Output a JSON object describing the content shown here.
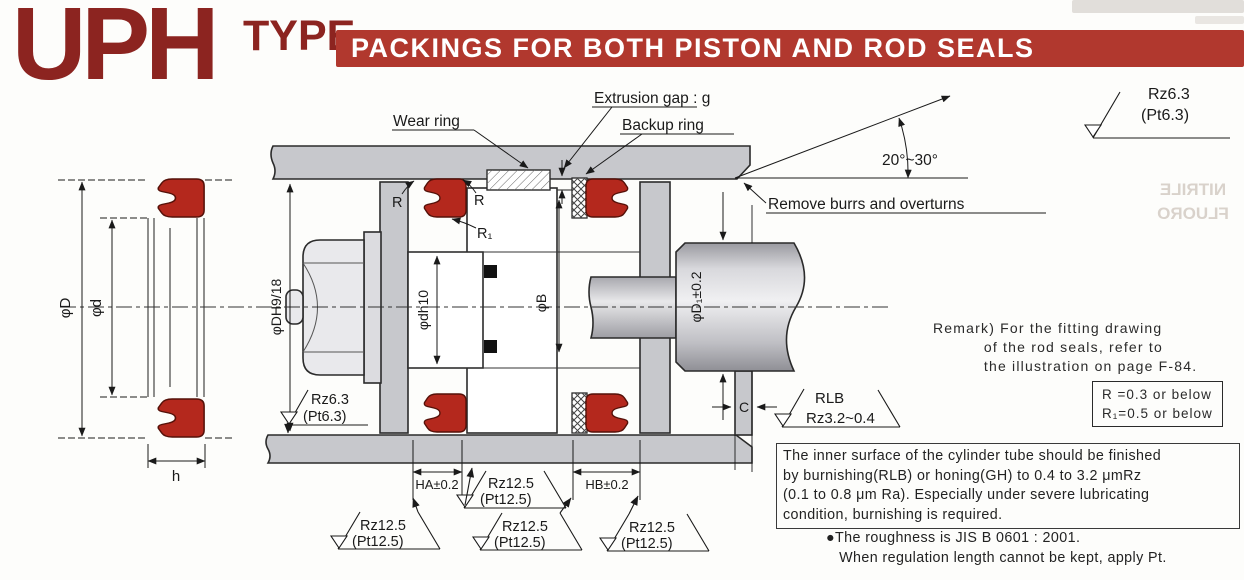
{
  "header": {
    "logo": "UPH",
    "logo_type": "TYPE",
    "banner": "PACKINGS FOR BOTH PISTON AND ROD SEALS"
  },
  "left_view": {
    "dim_outer": "φD",
    "dim_inner": "φd",
    "dim_height": "h"
  },
  "callouts": {
    "wear_ring": "Wear ring",
    "extrusion_gap": "Extrusion gap : g",
    "backup_ring": "Backup ring",
    "remove_burrs": "Remove burrs and overturns",
    "chamfer_angle": "20°~30°",
    "r": "R",
    "r1": "R₁"
  },
  "dims": {
    "housing_bore": "φDH9/18",
    "groove_dia": "φdh10",
    "bore_b": "φB",
    "rod_dia": "φD₁±0.2",
    "groove_width_a": "HA±0.2",
    "groove_width_b": "HB±0.2",
    "head_thickness": "C"
  },
  "surface": {
    "rz63": "Rz6.3",
    "pt63": "(Pt6.3)",
    "rz125": "Rz12.5",
    "pt125": "(Pt12.5)",
    "rlb": "RLB",
    "rz32": "Rz3.2~0.4"
  },
  "notes": {
    "remark": "Remark) For the fitting drawing\n          of the rod seals, refer to\n          the illustration on page F-84.",
    "r_box": "R =0.3 or below\nR₁=0.5 or below",
    "surface_box": "The inner surface of the cylinder tube should be finished\nby burnishing(RLB) or honing(GH) to 0.4 to 3.2 μmRz\n(0.1 to 0.8 μm Ra). Especially under severe lubricating\ncondition, burnishing is required.",
    "bullet": "●The roughness is JIS B 0601 : 2001.\n   When regulation length cannot be kept, apply Pt."
  },
  "ghost": {
    "text": "NITRILE\nFLUORO"
  }
}
